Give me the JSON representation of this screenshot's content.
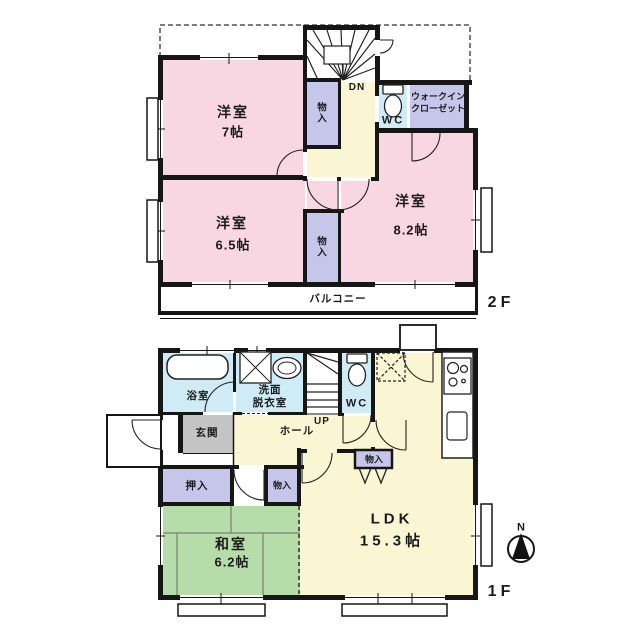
{
  "palette": {
    "paper": "#ffffff",
    "pink": "#f8d7e2",
    "lavender": "#c6c6ea",
    "cream": "#faf6d3",
    "lightblue": "#cfecf6",
    "green": "#b6dcaa",
    "gray": "#c5c5c5",
    "wall": "#161616"
  },
  "floor2": {
    "label": "2F",
    "room_7": {
      "name": "洋室",
      "size": "7帖"
    },
    "room_65": {
      "name": "洋室",
      "size": "6.5帖"
    },
    "room_82": {
      "name": "洋室",
      "size": "8.2帖"
    },
    "closet_upper": "物入",
    "closet_lower": "物入",
    "wic": {
      "line1": "ウォークイン",
      "line2": "クローゼット"
    },
    "wc": "WC",
    "stairs": "DN",
    "balcony": "バルコニー"
  },
  "floor1": {
    "label": "1F",
    "bath": "浴室",
    "washroom": {
      "line1": "洗面",
      "line2": "脱衣室"
    },
    "wc": "WC",
    "stairs": "UP",
    "entrance": "玄関",
    "hall": "ホール",
    "oshiire": "押入",
    "closet_hall": "物入",
    "closet_ldk": "物入",
    "washitsu": {
      "name": "和室",
      "size": "6.2帖"
    },
    "ldk": {
      "name": "LDK",
      "size": "15.3帖"
    }
  },
  "compass": {
    "label": "N"
  }
}
